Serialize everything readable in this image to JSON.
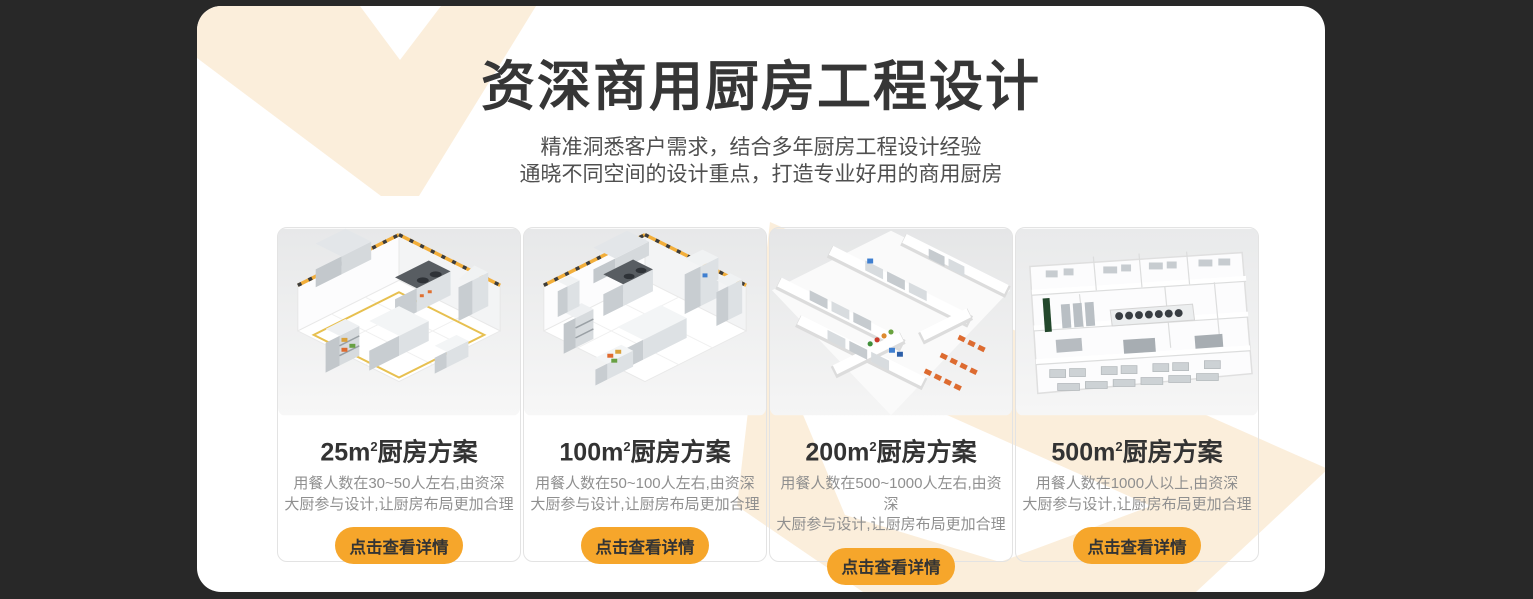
{
  "colors": {
    "page_background": "#282828",
    "panel_background": "#ffffff",
    "watermark_cream": "#fbeedb",
    "accent_orange": "#f6a62b",
    "title_text": "#363636",
    "subtitle_text": "#4f4f4f",
    "card_title_text": "#333333",
    "card_desc_text": "#8f8f8f",
    "card_border": "#e3e3e3"
  },
  "header": {
    "title": "资深商用厨房工程设计",
    "subtitle_line1": "精准洞悉客户需求，结合多年厨房工程设计经验",
    "subtitle_line2": "通晓不同空间的设计重点，打造专业好用的商用厨房"
  },
  "cards": [
    {
      "area": "25m",
      "sup": "2",
      "title_suffix": "厨房方案",
      "desc_line1": "用餐人数在30~50人左右,由资深",
      "desc_line2": "大厨参与设计,让厨房布局更加合理",
      "button_label": "点击查看详情",
      "image_name": "kitchen-render-25m2-isometric"
    },
    {
      "area": "100m",
      "sup": "2",
      "title_suffix": "厨房方案",
      "desc_line1": "用餐人数在50~100人左右,由资深",
      "desc_line2": "大厨参与设计,让厨房布局更加合理",
      "button_label": "点击查看详情",
      "image_name": "kitchen-render-100m2-isometric"
    },
    {
      "area": "200m",
      "sup": "2",
      "title_suffix": "厨房方案",
      "desc_line1": "用餐人数在500~1000人左右,由资深",
      "desc_line2": "大厨参与设计,让厨房布局更加合理",
      "button_label": "点击查看详情",
      "image_name": "kitchen-render-200m2-isometric"
    },
    {
      "area": "500m",
      "sup": "2",
      "title_suffix": "厨房方案",
      "desc_line1": "用餐人数在1000人以上,由资深",
      "desc_line2": "大厨参与设计,让厨房布局更加合理",
      "button_label": "点击查看详情",
      "image_name": "kitchen-render-500m2-floorplan"
    }
  ]
}
